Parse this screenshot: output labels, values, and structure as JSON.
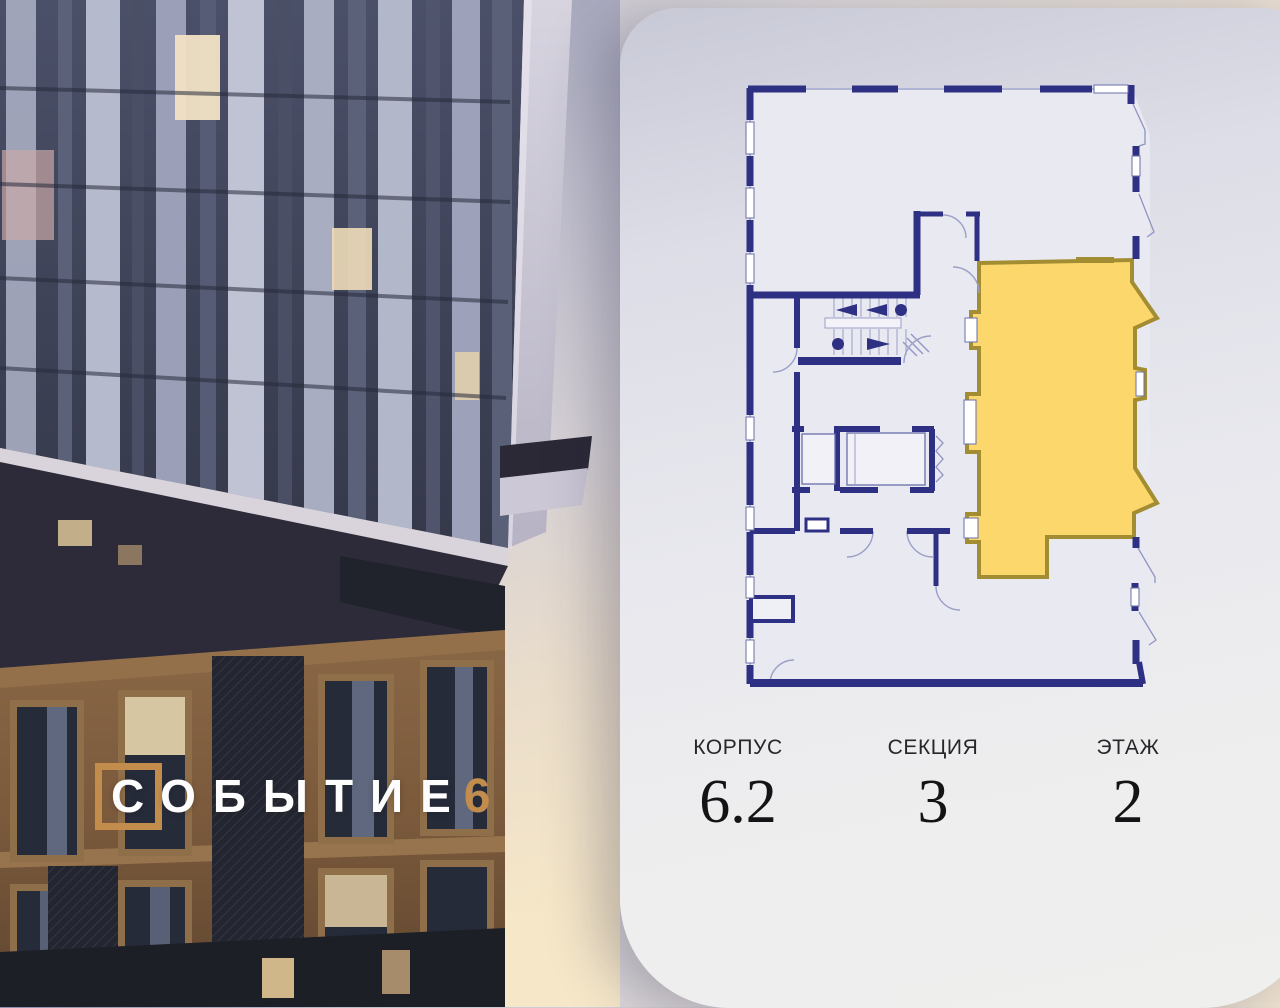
{
  "logo": {
    "text": "СОБЫТИЕ",
    "number": "6",
    "accent_color": "#c28d4c"
  },
  "plan": {
    "wall_color": "#2e3183",
    "highlight_fill": "#fbd76c",
    "highlight_stroke": "#a38d33"
  },
  "card": {
    "info": [
      {
        "label": "КОРПУС",
        "value": "6.2"
      },
      {
        "label": "СЕКЦИЯ",
        "value": "3"
      },
      {
        "label": "ЭТАЖ",
        "value": "2"
      }
    ]
  }
}
